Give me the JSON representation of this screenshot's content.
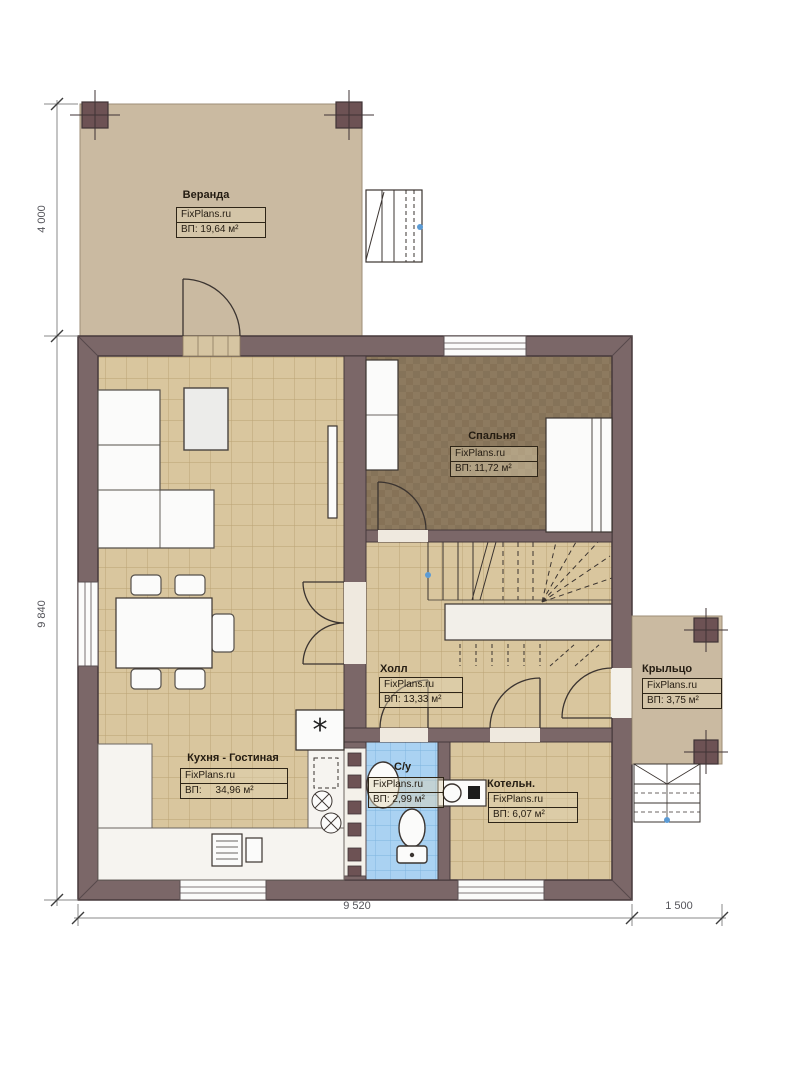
{
  "title": "План 1 этажа",
  "brand": "FixPlans.ru",
  "rooms": [
    {
      "id": "veranda",
      "name": "Веранда",
      "brand": "FixPlans.ru",
      "area": "ВП: 19,64 м²"
    },
    {
      "id": "bedroom",
      "name": "Спальня",
      "brand": "FixPlans.ru",
      "area": "ВП: 11,72 м²"
    },
    {
      "id": "hall",
      "name": "Холл",
      "brand": "FixPlans.ru",
      "area": "ВП: 13,33 м²"
    },
    {
      "id": "kitchen",
      "name": "Кухня - Гостиная",
      "brand": "FixPlans.ru",
      "area": "ВП:     34,96 м²"
    },
    {
      "id": "bathroom",
      "name": "С/у",
      "brand": "FixPlans.ru",
      "area": "ВП: 2,99 м²"
    },
    {
      "id": "boiler",
      "name": "Котельн.",
      "brand": "FixPlans.ru",
      "area": "ВП: 6,07 м²"
    },
    {
      "id": "porch",
      "name": "Крыльцо",
      "brand": "FixPlans.ru",
      "area": "ВП: 3,75 м²"
    }
  ],
  "dimensions": {
    "veranda_depth": "4 000",
    "house_depth": "9 840",
    "house_width": "9 520",
    "porch_width": "1 500"
  },
  "colors": {
    "wall": "#7b6768",
    "tile_floor": "#d9c69e",
    "tile_line": "#b9a173",
    "bedroom_floor": "#8d7a5f",
    "bathroom_tile": "#aad2f2",
    "veranda_floor": "#cabaa1",
    "marker_blue": "#5b9bd5"
  }
}
